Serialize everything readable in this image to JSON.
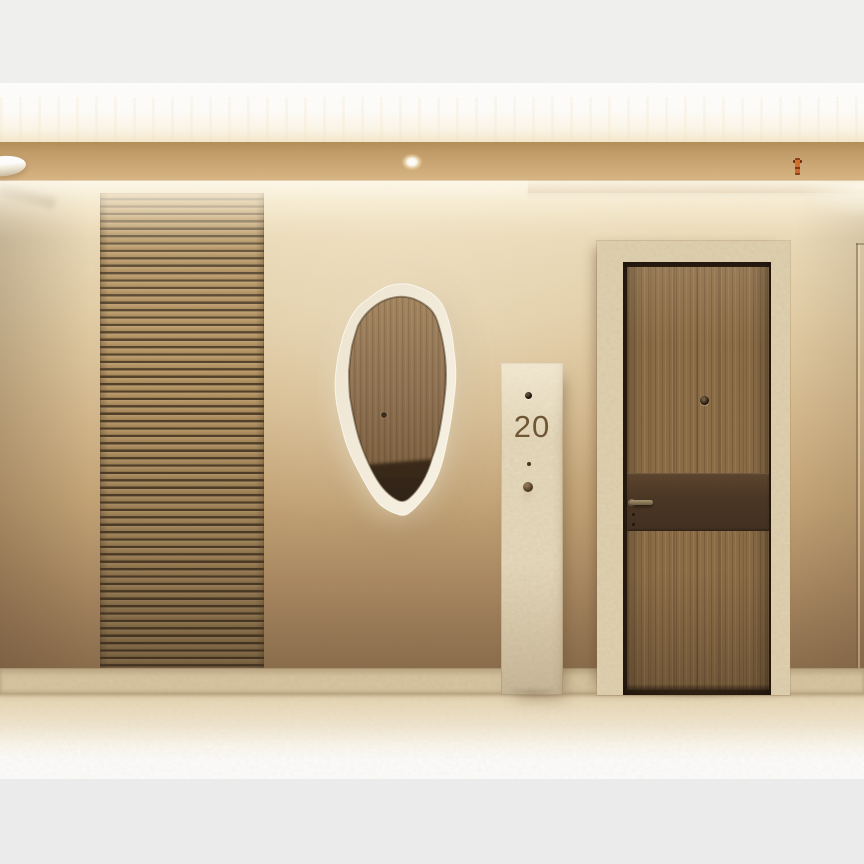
{
  "scene": {
    "alt": "Bright beige apartment corridor: plaster walls washed by cove light, a horizontal wood-slat panel, an organic rough-edged backlit mirror reflecting a wooden door, a travertine pillar sign with unit number, and a wooden entrance door with a dark bronze band inside a travertine portal.",
    "unit_sign": {
      "number": "20"
    },
    "icons": {
      "ceiling_lamp": "round-ceiling-lamp",
      "spotlight": "recessed-spotlight",
      "sprinkler": "fire-sprinkler",
      "door_camera": "camera-dot",
      "doorbell": "doorbell-button",
      "intercom_dot": "intercom-dot",
      "peephole": "door-peephole",
      "door_handle": "lever-handle",
      "keyhole": "double-keyhole"
    },
    "palette": {
      "letterbox_top": "#efefee",
      "letterbox_bottom": "#ebebec",
      "ceiling_white": "#ffffff",
      "bulkhead": "#c9a471",
      "wall_top": "#f2e6ca",
      "wall_bottom": "#8a6c4a",
      "slat_face": "#b2925f",
      "slat_gap": "#54402a",
      "travertine": "#e7d8b8",
      "door_wood": "#8a6b45",
      "door_band": "#4a3523",
      "handle_metal": "#96805f",
      "mirror_wood": "#8a6f4f",
      "floor": "#ead9b8",
      "sign_number_color": "#6e5634",
      "sprinkler_orange": "#cf6a28"
    }
  }
}
